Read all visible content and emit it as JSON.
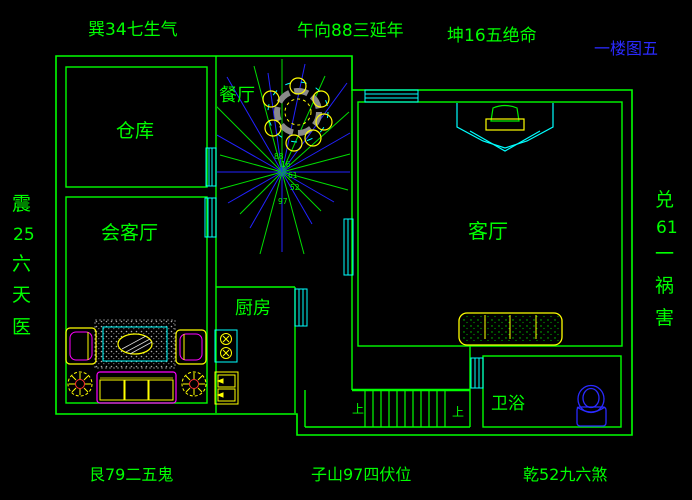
{
  "sheet": {
    "title": "一楼图五"
  },
  "feng_shui": {
    "top_left": "巽34七生气",
    "top_center": "午向88三延年",
    "top_right": "坤16五绝命",
    "left_vertical": [
      "震",
      "25",
      "六",
      "天",
      "医"
    ],
    "right_vertical": [
      "兑",
      "61",
      "一",
      "祸",
      "害"
    ],
    "bottom_left": "艮79二五鬼",
    "bottom_center": "子山97四伏位",
    "bottom_right": "乾52九六煞",
    "center_numbers": [
      "88",
      "16",
      "61",
      "52",
      "97"
    ]
  },
  "rooms": {
    "storage": "仓库",
    "reception": "会客厅",
    "dining": "餐厅",
    "kitchen": "厨房",
    "living": "客厅",
    "bathroom": "卫浴"
  },
  "stairs": {
    "up_left": "上",
    "up_right": "上"
  },
  "colors": {
    "background": "#000000",
    "wall": "#00ff00",
    "door_window": "#00ffff",
    "furniture_primary": "#ffff00",
    "furniture_accent": "#ff00ff",
    "compass_ray_blue": "#2222ff",
    "toilet_blue": "#2a2aff",
    "text_green": "#00ff00",
    "sheet_title_blue": "#2a2aff",
    "rug_gray": "#9a9a9a"
  }
}
